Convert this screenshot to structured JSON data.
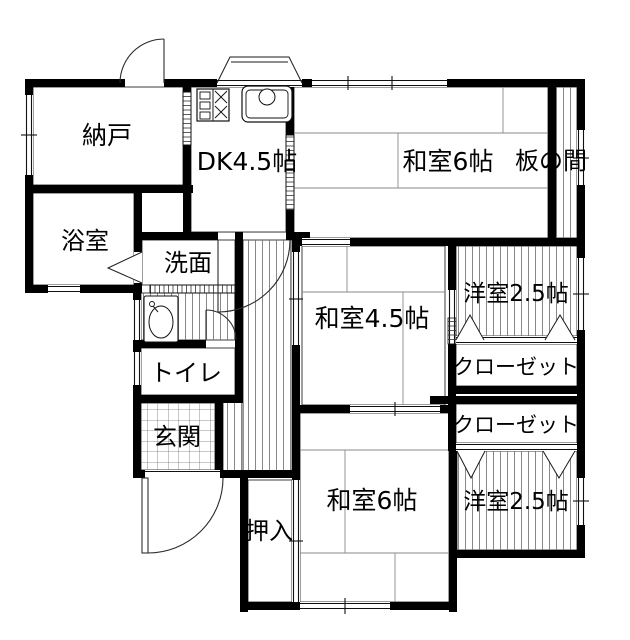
{
  "plan": {
    "type": "floor-plan",
    "colors": {
      "wall": "#000000",
      "background": "#ffffff",
      "line": "#1b1b1b"
    },
    "rooms": [
      {
        "id": "nando",
        "label": "納戸"
      },
      {
        "id": "dk",
        "label": "DK4.5帖"
      },
      {
        "id": "washitsu6-top",
        "label": "和室6帖"
      },
      {
        "id": "itanoma",
        "label": "板の間"
      },
      {
        "id": "yokushitsu",
        "label": "浴室"
      },
      {
        "id": "senmen",
        "label": "洗面"
      },
      {
        "id": "toire",
        "label": "トイレ"
      },
      {
        "id": "genkan",
        "label": "玄関"
      },
      {
        "id": "washitsu45",
        "label": "和室4.5帖"
      },
      {
        "id": "yoshitsu25-top",
        "label": "洋室2.5帖"
      },
      {
        "id": "closet-1",
        "label": "クローゼット"
      },
      {
        "id": "closet-2",
        "label": "クローゼット"
      },
      {
        "id": "washitsu6-bottom",
        "label": "和室6帖"
      },
      {
        "id": "oshiire",
        "label": "押入"
      },
      {
        "id": "yoshitsu25-bottom",
        "label": "洋室2.5帖"
      }
    ],
    "fixtures": [
      {
        "id": "stove",
        "name": "gas-stove"
      },
      {
        "id": "sink",
        "name": "kitchen-sink"
      },
      {
        "id": "basin",
        "name": "wash-basin"
      }
    ]
  }
}
